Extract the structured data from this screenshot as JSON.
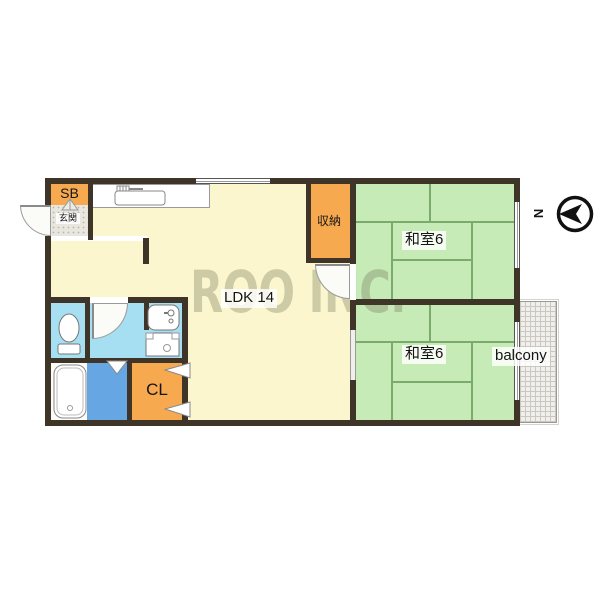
{
  "rooms": {
    "ldk": {
      "label": "LDK 14"
    },
    "japanese_room_top": {
      "label": "和室6"
    },
    "japanese_room_bottom": {
      "label": "和室6"
    },
    "storage": {
      "label": "収納"
    },
    "shoe_box": {
      "label": "SB"
    },
    "entrance": {
      "label": "玄関"
    },
    "closet": {
      "label": "CL"
    },
    "balcony": {
      "label": "balcony"
    }
  },
  "compass": {
    "label": "N"
  },
  "watermark": {
    "text": "ROO INC."
  },
  "colors": {
    "wall": "#3f3428",
    "ldk": "#fbf6cd",
    "tatami": "#c6ebb7",
    "tatami_line": "#7aab6d",
    "orange": "#f7a950",
    "water": "#a6dff1",
    "bath": "#66a7e3",
    "tub_room": "#fcfcf8",
    "entrance": "#e9e6e0",
    "balcony": "#f0efeb",
    "watermark": "rgba(110,116,88,0.33)"
  },
  "icons": {
    "compass_north": "circle with left-pointing arrow",
    "kitchen_sink": "counter sink with faucet",
    "toilet": "toilet bowl with tank",
    "washbasin": "basin with faucet",
    "washing_machine": "square with drum circle",
    "bathtub": "oval bathtub",
    "door_swing": "quarter-circle arc"
  }
}
